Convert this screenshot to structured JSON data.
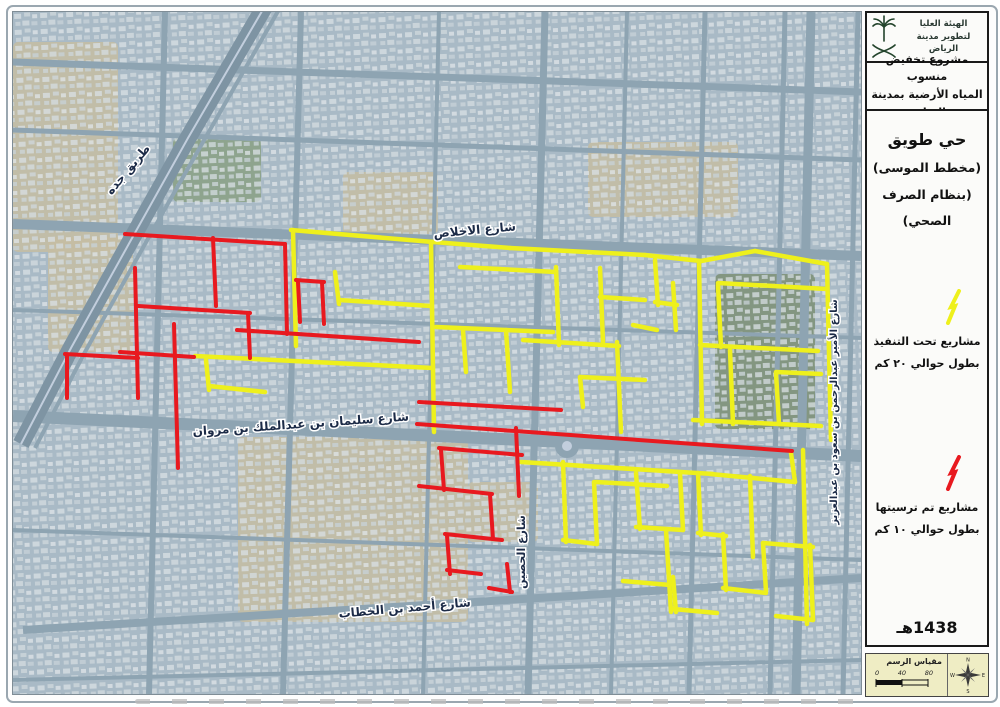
{
  "sidebar": {
    "logo": {
      "org_line1": "الهيئة العليا",
      "org_line2": "لتطوير مدينة الرياض",
      "emblem": "saudi-palm-and-swords"
    },
    "project_title_line1": "مشروع تخفيض منسوب",
    "project_title_line2": "المياه الأرضية بمدينة الرياض",
    "district": {
      "line1": "حي طويق",
      "line2": "(مخطط الموسى)",
      "line3": "(بنظام الصرف الصحي)"
    },
    "legend": [
      {
        "color": "#eef01c",
        "label_line1": "مشاريع تحت التنفيذ",
        "label_line2": "بطول حوالي ٢٠ كم"
      },
      {
        "color": "#e8191f",
        "label_line1": "مشاريع تم ترسيتها",
        "label_line2": "بطول حوالي ١٠ كم"
      }
    ],
    "year": "1438هـ",
    "scale": {
      "title": "مقياس الرسم",
      "ticks": [
        "0",
        "40",
        "80"
      ],
      "compass": {
        "n": "N",
        "e": "E",
        "s": "S",
        "w": "W"
      }
    }
  },
  "map": {
    "colors": {
      "base": "#a9bac6",
      "road": "#8ea4b2",
      "highway": "#7e94a3",
      "median": "#c2cedd",
      "sand": "#c6bda2",
      "green": "#8aa084",
      "green2": "#7c8f74",
      "label": "#1c2b47",
      "red": "#e8191f",
      "yellow": "#eef01c"
    },
    "street_labels": [
      {
        "text": "طريق جده",
        "x": 118,
        "y": 160,
        "rot": -50,
        "size": 12
      },
      {
        "text": "شارع الاخلاص",
        "x": 462,
        "y": 222,
        "rot": -5,
        "size": 12
      },
      {
        "text": "شارع سليمان بن عبدالملك بن مروان",
        "x": 288,
        "y": 416,
        "rot": -4,
        "size": 12
      },
      {
        "text": "شارع أحمد بن الخطاب",
        "x": 392,
        "y": 600,
        "rot": -5,
        "size": 12
      },
      {
        "text": "شارع الحصين",
        "x": 512,
        "y": 540,
        "rot": -90,
        "size": 11
      },
      {
        "text": "شارع الأمير عبدالرحمن بن سعود بن عبدالعزيز",
        "x": 824,
        "y": 400,
        "rot": -90,
        "size": 10
      }
    ],
    "patches": [
      {
        "x": 0,
        "y": 30,
        "w": 105,
        "h": 210,
        "c": "sand"
      },
      {
        "x": 35,
        "y": 225,
        "w": 85,
        "h": 115,
        "c": "sand"
      },
      {
        "x": 225,
        "y": 425,
        "w": 230,
        "h": 185,
        "c": "sand"
      },
      {
        "x": 330,
        "y": 160,
        "w": 95,
        "h": 62,
        "c": "sand"
      },
      {
        "x": 575,
        "y": 130,
        "w": 150,
        "h": 75,
        "c": "sand"
      },
      {
        "x": 455,
        "y": 470,
        "w": 70,
        "h": 60,
        "c": "sand"
      },
      {
        "x": 160,
        "y": 126,
        "w": 88,
        "h": 64,
        "c": "green"
      },
      {
        "x": 702,
        "y": 262,
        "w": 100,
        "h": 155,
        "c": "green2"
      }
    ],
    "roads": {
      "horizontal": [
        {
          "x1": 0,
          "y1": 50,
          "x2": 848,
          "y2": 80,
          "w": 7
        },
        {
          "x1": 0,
          "y1": 118,
          "x2": 848,
          "y2": 148,
          "w": 5
        },
        {
          "x1": 0,
          "y1": 212,
          "x2": 848,
          "y2": 244,
          "w": 10
        },
        {
          "x1": 0,
          "y1": 298,
          "x2": 848,
          "y2": 326,
          "w": 4
        },
        {
          "x1": 0,
          "y1": 404,
          "x2": 848,
          "y2": 444,
          "w": 12
        },
        {
          "x1": 0,
          "y1": 518,
          "x2": 848,
          "y2": 548,
          "w": 4
        },
        {
          "x1": 10,
          "y1": 618,
          "x2": 848,
          "y2": 566,
          "w": 8
        },
        {
          "x1": 0,
          "y1": 668,
          "x2": 848,
          "y2": 648,
          "w": 4
        }
      ],
      "vertical": [
        {
          "x1": 152,
          "y1": 0,
          "x2": 136,
          "y2": 682,
          "w": 6
        },
        {
          "x1": 288,
          "y1": 0,
          "x2": 270,
          "y2": 682,
          "w": 6
        },
        {
          "x1": 426,
          "y1": 0,
          "x2": 410,
          "y2": 682,
          "w": 4
        },
        {
          "x1": 532,
          "y1": 0,
          "x2": 515,
          "y2": 682,
          "w": 7
        },
        {
          "x1": 614,
          "y1": 0,
          "x2": 598,
          "y2": 682,
          "w": 4
        },
        {
          "x1": 692,
          "y1": 0,
          "x2": 676,
          "y2": 682,
          "w": 5
        },
        {
          "x1": 772,
          "y1": 0,
          "x2": 757,
          "y2": 682,
          "w": 5
        },
        {
          "x1": 798,
          "y1": 0,
          "x2": 783,
          "y2": 682,
          "w": 9
        },
        {
          "x1": 845,
          "y1": 0,
          "x2": 830,
          "y2": 682,
          "w": 5
        }
      ],
      "highway": [
        [
          252,
          -6
        ],
        [
          175,
          126
        ],
        [
          118,
          228
        ],
        [
          58,
          336
        ],
        [
          8,
          432
        ]
      ],
      "service": [
        [
          268,
          -6
        ],
        [
          190,
          130
        ],
        [
          132,
          232
        ],
        [
          72,
          340
        ],
        [
          22,
          436
        ]
      ],
      "roundabout": {
        "x": 554,
        "y": 434,
        "r": 12
      }
    },
    "yellow_lines": [
      [
        [
          278,
          218
        ],
        [
          420,
          230
        ]
      ],
      [
        [
          280,
          218
        ],
        [
          283,
          334
        ]
      ],
      [
        [
          420,
          230
        ],
        [
          497,
          236
        ]
      ],
      [
        [
          497,
          236
        ],
        [
          632,
          243
        ]
      ],
      [
        [
          632,
          243
        ],
        [
          688,
          249
        ]
      ],
      [
        [
          688,
          249
        ],
        [
          742,
          239
        ]
      ],
      [
        [
          742,
          239
        ],
        [
          814,
          252
        ]
      ],
      [
        [
          814,
          252
        ],
        [
          818,
          428
        ]
      ],
      [
        [
          182,
          344
        ],
        [
          420,
          356
        ]
      ],
      [
        [
          193,
          348
        ],
        [
          196,
          378
        ]
      ],
      [
        [
          196,
          374
        ],
        [
          252,
          380
        ]
      ],
      [
        [
          322,
          260
        ],
        [
          326,
          292
        ]
      ],
      [
        [
          326,
          288
        ],
        [
          418,
          294
        ]
      ],
      [
        [
          418,
          230
        ],
        [
          421,
          420
        ]
      ],
      [
        [
          447,
          255
        ],
        [
          543,
          260
        ]
      ],
      [
        [
          543,
          255
        ],
        [
          546,
          333
        ]
      ],
      [
        [
          423,
          315
        ],
        [
          540,
          320
        ]
      ],
      [
        [
          450,
          318
        ],
        [
          453,
          360
        ]
      ],
      [
        [
          493,
          318
        ],
        [
          497,
          380
        ]
      ],
      [
        [
          587,
          256
        ],
        [
          590,
          330
        ]
      ],
      [
        [
          587,
          285
        ],
        [
          632,
          288
        ]
      ],
      [
        [
          510,
          328
        ],
        [
          606,
          334
        ]
      ],
      [
        [
          604,
          330
        ],
        [
          608,
          420
        ]
      ],
      [
        [
          567,
          365
        ],
        [
          632,
          368
        ]
      ],
      [
        [
          567,
          365
        ],
        [
          570,
          395
        ]
      ],
      [
        [
          642,
          248
        ],
        [
          645,
          293
        ]
      ],
      [
        [
          642,
          290
        ],
        [
          664,
          293
        ]
      ],
      [
        [
          660,
          271
        ],
        [
          663,
          318
        ]
      ],
      [
        [
          620,
          313
        ],
        [
          644,
          318
        ]
      ],
      [
        [
          686,
          250
        ],
        [
          689,
          412
        ]
      ],
      [
        [
          705,
          271
        ],
        [
          814,
          277
        ]
      ],
      [
        [
          705,
          273
        ],
        [
          708,
          335
        ]
      ],
      [
        [
          687,
          333
        ],
        [
          805,
          339
        ]
      ],
      [
        [
          717,
          338
        ],
        [
          720,
          412
        ]
      ],
      [
        [
          763,
          360
        ],
        [
          808,
          362
        ]
      ],
      [
        [
          763,
          361
        ],
        [
          766,
          412
        ]
      ],
      [
        [
          680,
          408
        ],
        [
          808,
          414
        ]
      ],
      [
        [
          790,
          438
        ],
        [
          794,
          612
        ]
      ],
      [
        [
          508,
          450
        ],
        [
          700,
          462
        ]
      ],
      [
        [
          697,
          462
        ],
        [
          740,
          466
        ]
      ],
      [
        [
          737,
          464
        ],
        [
          740,
          545
        ]
      ],
      [
        [
          740,
          466
        ],
        [
          782,
          470
        ]
      ],
      [
        [
          778,
          441
        ],
        [
          782,
          470
        ]
      ],
      [
        [
          550,
          450
        ],
        [
          553,
          530
        ]
      ],
      [
        [
          550,
          528
        ],
        [
          584,
          532
        ]
      ],
      [
        [
          581,
          470
        ],
        [
          584,
          532
        ]
      ],
      [
        [
          583,
          470
        ],
        [
          654,
          474
        ]
      ],
      [
        [
          623,
          461
        ],
        [
          627,
          517
        ]
      ],
      [
        [
          623,
          515
        ],
        [
          670,
          518
        ]
      ],
      [
        [
          667,
          461
        ],
        [
          670,
          518
        ]
      ],
      [
        [
          653,
          518
        ],
        [
          658,
          600
        ]
      ],
      [
        [
          610,
          569
        ],
        [
          657,
          573
        ]
      ],
      [
        [
          685,
          461
        ],
        [
          688,
          523
        ]
      ],
      [
        [
          685,
          521
        ],
        [
          713,
          524
        ]
      ],
      [
        [
          710,
          522
        ],
        [
          713,
          578
        ]
      ],
      [
        [
          710,
          576
        ],
        [
          753,
          581
        ]
      ],
      [
        [
          750,
          531
        ],
        [
          753,
          579
        ]
      ],
      [
        [
          750,
          531
        ],
        [
          800,
          535
        ]
      ],
      [
        [
          797,
          533
        ],
        [
          800,
          608
        ]
      ],
      [
        [
          763,
          604
        ],
        [
          800,
          608
        ]
      ],
      [
        [
          660,
          565
        ],
        [
          663,
          600
        ]
      ],
      [
        [
          660,
          597
        ],
        [
          704,
          601
        ]
      ]
    ],
    "red_lines": [
      [
        [
          112,
          222
        ],
        [
          272,
          232
        ]
      ],
      [
        [
          200,
          226
        ],
        [
          203,
          294
        ]
      ],
      [
        [
          272,
          232
        ],
        [
          274,
          322
        ]
      ],
      [
        [
          122,
          256
        ],
        [
          125,
          386
        ]
      ],
      [
        [
          52,
          342
        ],
        [
          125,
          346
        ]
      ],
      [
        [
          54,
          344
        ],
        [
          54,
          386
        ]
      ],
      [
        [
          125,
          294
        ],
        [
          237,
          301
        ]
      ],
      [
        [
          235,
          301
        ],
        [
          237,
          346
        ]
      ],
      [
        [
          161,
          312
        ],
        [
          165,
          456
        ]
      ],
      [
        [
          107,
          340
        ],
        [
          181,
          345
        ]
      ],
      [
        [
          224,
          318
        ],
        [
          406,
          330
        ]
      ],
      [
        [
          283,
          268
        ],
        [
          311,
          270
        ]
      ],
      [
        [
          309,
          270
        ],
        [
          311,
          312
        ]
      ],
      [
        [
          285,
          270
        ],
        [
          287,
          310
        ]
      ],
      [
        [
          406,
          390
        ],
        [
          548,
          398
        ]
      ],
      [
        [
          404,
          412
        ],
        [
          779,
          439
        ]
      ],
      [
        [
          503,
          416
        ],
        [
          506,
          484
        ]
      ],
      [
        [
          426,
          436
        ],
        [
          509,
          443
        ]
      ],
      [
        [
          428,
          438
        ],
        [
          431,
          478
        ]
      ],
      [
        [
          406,
          474
        ],
        [
          479,
          482
        ]
      ],
      [
        [
          477,
          482
        ],
        [
          480,
          527
        ]
      ],
      [
        [
          432,
          522
        ],
        [
          489,
          528
        ]
      ],
      [
        [
          434,
          524
        ],
        [
          437,
          562
        ]
      ],
      [
        [
          434,
          558
        ],
        [
          468,
          562
        ]
      ],
      [
        [
          494,
          552
        ],
        [
          497,
          580
        ]
      ],
      [
        [
          476,
          576
        ],
        [
          499,
          580
        ]
      ]
    ]
  }
}
